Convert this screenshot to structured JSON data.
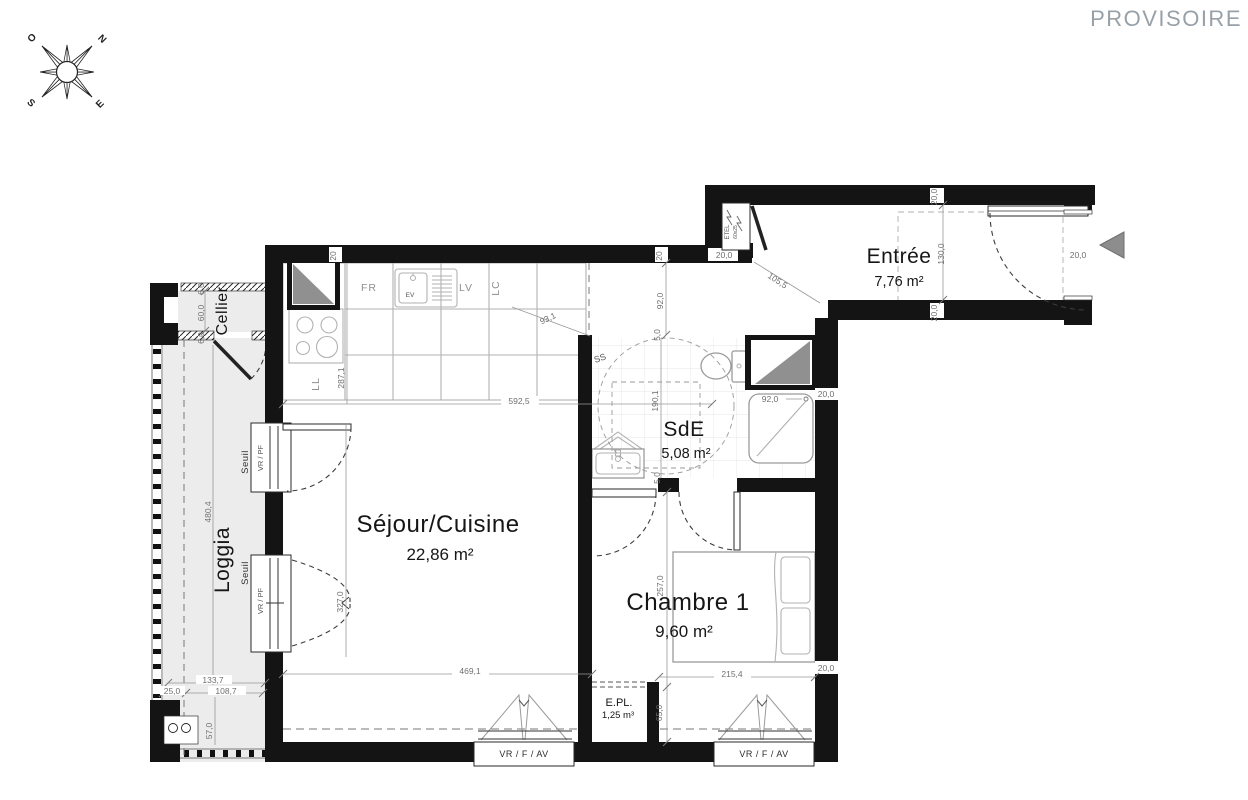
{
  "watermark": "PROVISOIRE",
  "compass": {
    "n": "N",
    "s": "S",
    "e": "E",
    "o": "O"
  },
  "rooms": {
    "entree": {
      "name": "Entrée",
      "area": "7,76 m²"
    },
    "sde": {
      "name": "SdE",
      "area": "5,08 m²"
    },
    "sejour": {
      "name": "Séjour/Cuisine",
      "area": "22,86 m²"
    },
    "chambre": {
      "name": "Chambre 1",
      "area": "9,60 m²"
    },
    "epl": {
      "name": "E.PL.",
      "volume": "1,25 m³"
    },
    "cellier": {
      "name": "Cellier"
    },
    "loggia": {
      "name": "Loggia"
    }
  },
  "equipment": {
    "fridge": "FR",
    "dishwasher": "LV",
    "lc": "LC",
    "washer": "LL",
    "sink": "EV",
    "towel_dryer": "SS",
    "elec_panel": "ETEL",
    "elec_panel_size": "60x25"
  },
  "openings": {
    "window_shutter": "VR / PF",
    "window_fixed_shutter": "VR / F / AV",
    "threshold": "Seuil"
  },
  "dims": {
    "d592_5": "592,5",
    "d287_1": "287,1",
    "d93_1": "93,1",
    "d92_0": "92,0",
    "d190_1": "190,1",
    "d5_0": "5,0",
    "d20": "20",
    "d20_0": "20,0",
    "d130_0": "130,0",
    "d105_5": "105,5",
    "d327_0": "327,0",
    "d469_1": "469,1",
    "d257_0": "257,0",
    "d215_4": "215,4",
    "d65_0": "65,0",
    "d480_4": "480,4",
    "d60_0": "60,0",
    "d6_0": "6,0",
    "d133_7": "133,7",
    "d25_0": "25,0",
    "d108_7": "108,7",
    "d57_0": "57,0"
  }
}
